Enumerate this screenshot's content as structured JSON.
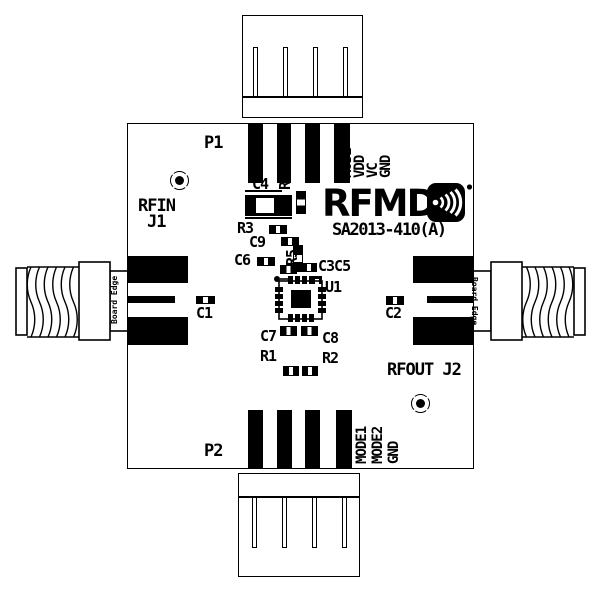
{
  "colors": {
    "ink": "#000000",
    "bg": "#ffffff"
  },
  "logo": {
    "brand": "RFMD",
    "part": "SA2013-410(A)",
    "icon": "rfmd-wireless-arcs-icon"
  },
  "headers": {
    "p1": "P1",
    "p2": "P2",
    "top_pins": [
      "MODE",
      "VDD",
      "VC",
      "GND"
    ],
    "bottom_pins": [
      "GND",
      "MODE1",
      "MODE2",
      "GND"
    ]
  },
  "rf": {
    "in_line1": "RFIN",
    "in_line2": "J1",
    "out": "RFOUT J2",
    "board_edge": "Board Edge"
  },
  "refdes": {
    "C1": "C1",
    "C2": "C2",
    "C3C5": "C3C5",
    "C4": "C4",
    "C6": "C6",
    "C7": "C7",
    "C8": "C8",
    "C9": "C9",
    "R1": "R1",
    "R2": "R2",
    "R3": "R3",
    "R4": "R4",
    "R5": "R5",
    "U1": "U1"
  }
}
